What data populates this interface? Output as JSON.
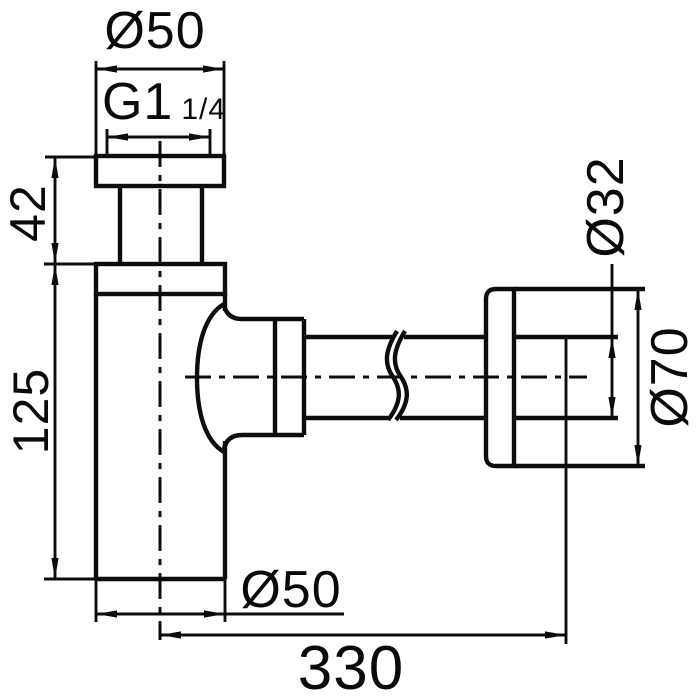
{
  "drawing": {
    "background_color": "#ffffff",
    "line_color": "#0d0d0d",
    "labels": {
      "top_diameter": "Ø50",
      "thread_size": "G1",
      "thread_fraction": "1/4",
      "inlet_height": "42",
      "body_height": "125",
      "body_diameter": "Ø50",
      "pipe_diameter": "Ø32",
      "flange_diameter": "Ø70",
      "total_length": "330"
    }
  }
}
